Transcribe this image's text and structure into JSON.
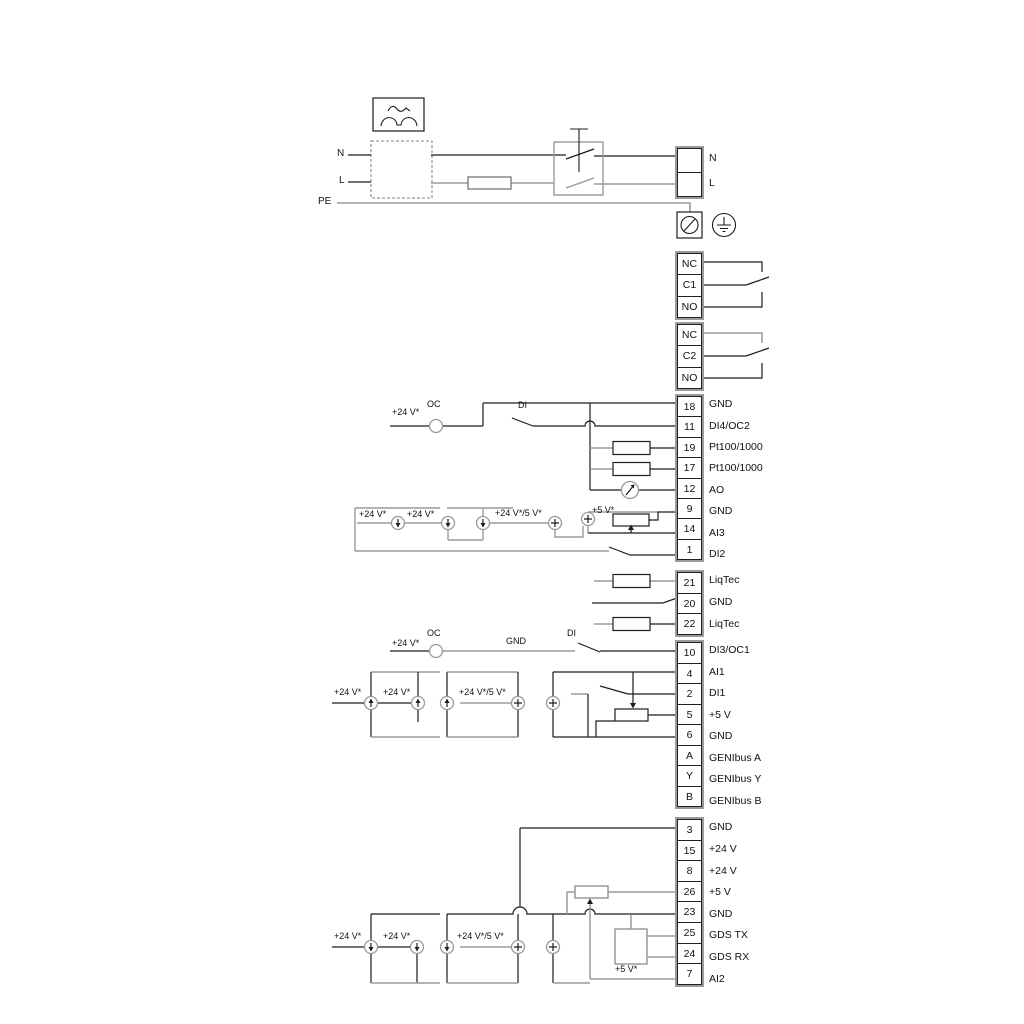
{
  "diagram": {
    "colors": {
      "wire_black": "#1c1c1c",
      "wire_gray": "#9a9a9a",
      "border_black": "#1f1f1f",
      "border_gray": "#9a9a9a",
      "text": "#111111",
      "background": "#ffffff"
    },
    "strips": [
      {
        "id": "power-terminal",
        "x": 675,
        "y": 146,
        "cell_h": 25,
        "label_x": 709,
        "rows": [
          {
            "num": "",
            "label": "N"
          },
          {
            "num": "",
            "label": "L"
          }
        ]
      },
      {
        "id": "relay-1",
        "x": 675,
        "y": 251,
        "cell_h": 22.3,
        "label_x": 709,
        "rows": [
          {
            "num": "NC",
            "label": ""
          },
          {
            "num": "C1",
            "label": ""
          },
          {
            "num": "NO",
            "label": ""
          }
        ]
      },
      {
        "id": "relay-2",
        "x": 675,
        "y": 322,
        "cell_h": 22.3,
        "label_x": 709,
        "rows": [
          {
            "num": "NC",
            "label": ""
          },
          {
            "num": "C2",
            "label": ""
          },
          {
            "num": "NO",
            "label": ""
          }
        ]
      },
      {
        "id": "io-strip-1",
        "x": 675,
        "y": 394,
        "cell_h": 21.4,
        "label_x": 709,
        "rows": [
          {
            "num": "18",
            "label": "GND"
          },
          {
            "num": "11",
            "label": "DI4/OC2"
          },
          {
            "num": "19",
            "label": "Pt100/1000"
          },
          {
            "num": "17",
            "label": "Pt100/1000"
          },
          {
            "num": "12",
            "label": "AO"
          },
          {
            "num": "9",
            "label": "GND"
          },
          {
            "num": "14",
            "label": "AI3"
          },
          {
            "num": "1",
            "label": "DI2"
          }
        ]
      },
      {
        "id": "liqtec-strip",
        "x": 675,
        "y": 570,
        "cell_h": 21.7,
        "label_x": 709,
        "rows": [
          {
            "num": "21",
            "label": "LiqTec"
          },
          {
            "num": "20",
            "label": "GND"
          },
          {
            "num": "22",
            "label": "LiqTec"
          }
        ]
      },
      {
        "id": "io-strip-2",
        "x": 675,
        "y": 640,
        "cell_h": 21.5,
        "label_x": 709,
        "rows": [
          {
            "num": "10",
            "label": "DI3/OC1"
          },
          {
            "num": "4",
            "label": "AI1"
          },
          {
            "num": "2",
            "label": "DI1"
          },
          {
            "num": "5",
            "label": "+5 V"
          },
          {
            "num": "6",
            "label": "GND"
          },
          {
            "num": "A",
            "label": "GENIbus A"
          },
          {
            "num": "Y",
            "label": "GENIbus Y"
          },
          {
            "num": "B",
            "label": "GENIbus B"
          }
        ]
      },
      {
        "id": "io-strip-3",
        "x": 675,
        "y": 817,
        "cell_h": 21.6,
        "label_x": 709,
        "rows": [
          {
            "num": "3",
            "label": "GND"
          },
          {
            "num": "15",
            "label": "+24 V"
          },
          {
            "num": "8",
            "label": "+24 V"
          },
          {
            "num": "26",
            "label": "+5 V"
          },
          {
            "num": "23",
            "label": "GND"
          },
          {
            "num": "25",
            "label": "GDS TX"
          },
          {
            "num": "24",
            "label": "GDS RX"
          },
          {
            "num": "7",
            "label": "AI2"
          }
        ]
      }
    ],
    "annotations": [
      {
        "id": "n-left",
        "text": "N",
        "x": 337,
        "y": 148,
        "size": 10
      },
      {
        "id": "l-left",
        "text": "L",
        "x": 339,
        "y": 175,
        "size": 10
      },
      {
        "id": "pe-left",
        "text": "PE",
        "x": 318,
        "y": 196,
        "size": 10
      },
      {
        "id": "oc-1",
        "text": "OC",
        "x": 427,
        "y": 399
      },
      {
        "id": "v24-1",
        "text": "+24 V*",
        "x": 392,
        "y": 407
      },
      {
        "id": "di-1",
        "text": "DI",
        "x": 518,
        "y": 400
      },
      {
        "id": "v24-2",
        "text": "+24 V*",
        "x": 359,
        "y": 509
      },
      {
        "id": "v24-3",
        "text": "+24 V*",
        "x": 407,
        "y": 509
      },
      {
        "id": "v24-5-1",
        "text": "+24 V*/5 V*",
        "x": 495,
        "y": 508
      },
      {
        "id": "v5-1",
        "text": "+5 V*",
        "x": 592,
        "y": 505
      },
      {
        "id": "v24-4",
        "text": "+24 V*",
        "x": 392,
        "y": 638
      },
      {
        "id": "oc-2",
        "text": "OC",
        "x": 427,
        "y": 628
      },
      {
        "id": "gnd-ann",
        "text": "GND",
        "x": 506,
        "y": 636
      },
      {
        "id": "di-2",
        "text": "DI",
        "x": 567,
        "y": 628
      },
      {
        "id": "v24-5",
        "text": "+24 V*",
        "x": 334,
        "y": 687
      },
      {
        "id": "v24-6",
        "text": "+24 V*",
        "x": 383,
        "y": 687
      },
      {
        "id": "v24-5-2",
        "text": "+24 V*/5 V*",
        "x": 459,
        "y": 687
      },
      {
        "id": "v24-7",
        "text": "+24 V*",
        "x": 334,
        "y": 931
      },
      {
        "id": "v24-8",
        "text": "+24 V*",
        "x": 383,
        "y": 931
      },
      {
        "id": "v24-5-3",
        "text": "+24 V*/5 V*",
        "x": 457,
        "y": 931
      },
      {
        "id": "v5-2",
        "text": "+5 V*",
        "x": 615,
        "y": 964
      }
    ],
    "sources": [
      {
        "x": 436,
        "y": 426,
        "glyph": "oc"
      },
      {
        "x": 398,
        "y": 523,
        "glyph": "down"
      },
      {
        "x": 448,
        "y": 523,
        "glyph": "down"
      },
      {
        "x": 483,
        "y": 523,
        "glyph": "down"
      },
      {
        "x": 555,
        "y": 523,
        "glyph": "plus"
      },
      {
        "x": 588,
        "y": 519,
        "glyph": "plus"
      },
      {
        "x": 436,
        "y": 651,
        "glyph": "oc"
      },
      {
        "x": 371,
        "y": 703,
        "glyph": "up"
      },
      {
        "x": 418,
        "y": 703,
        "glyph": "up"
      },
      {
        "x": 447,
        "y": 703,
        "glyph": "up"
      },
      {
        "x": 518,
        "y": 703,
        "glyph": "plus"
      },
      {
        "x": 553,
        "y": 703,
        "glyph": "plus"
      },
      {
        "x": 371,
        "y": 947,
        "glyph": "down"
      },
      {
        "x": 417,
        "y": 947,
        "glyph": "down"
      },
      {
        "x": 447,
        "y": 947,
        "glyph": "down"
      },
      {
        "x": 518,
        "y": 947,
        "glyph": "plus"
      },
      {
        "x": 553,
        "y": 947,
        "glyph": "plus"
      }
    ]
  }
}
